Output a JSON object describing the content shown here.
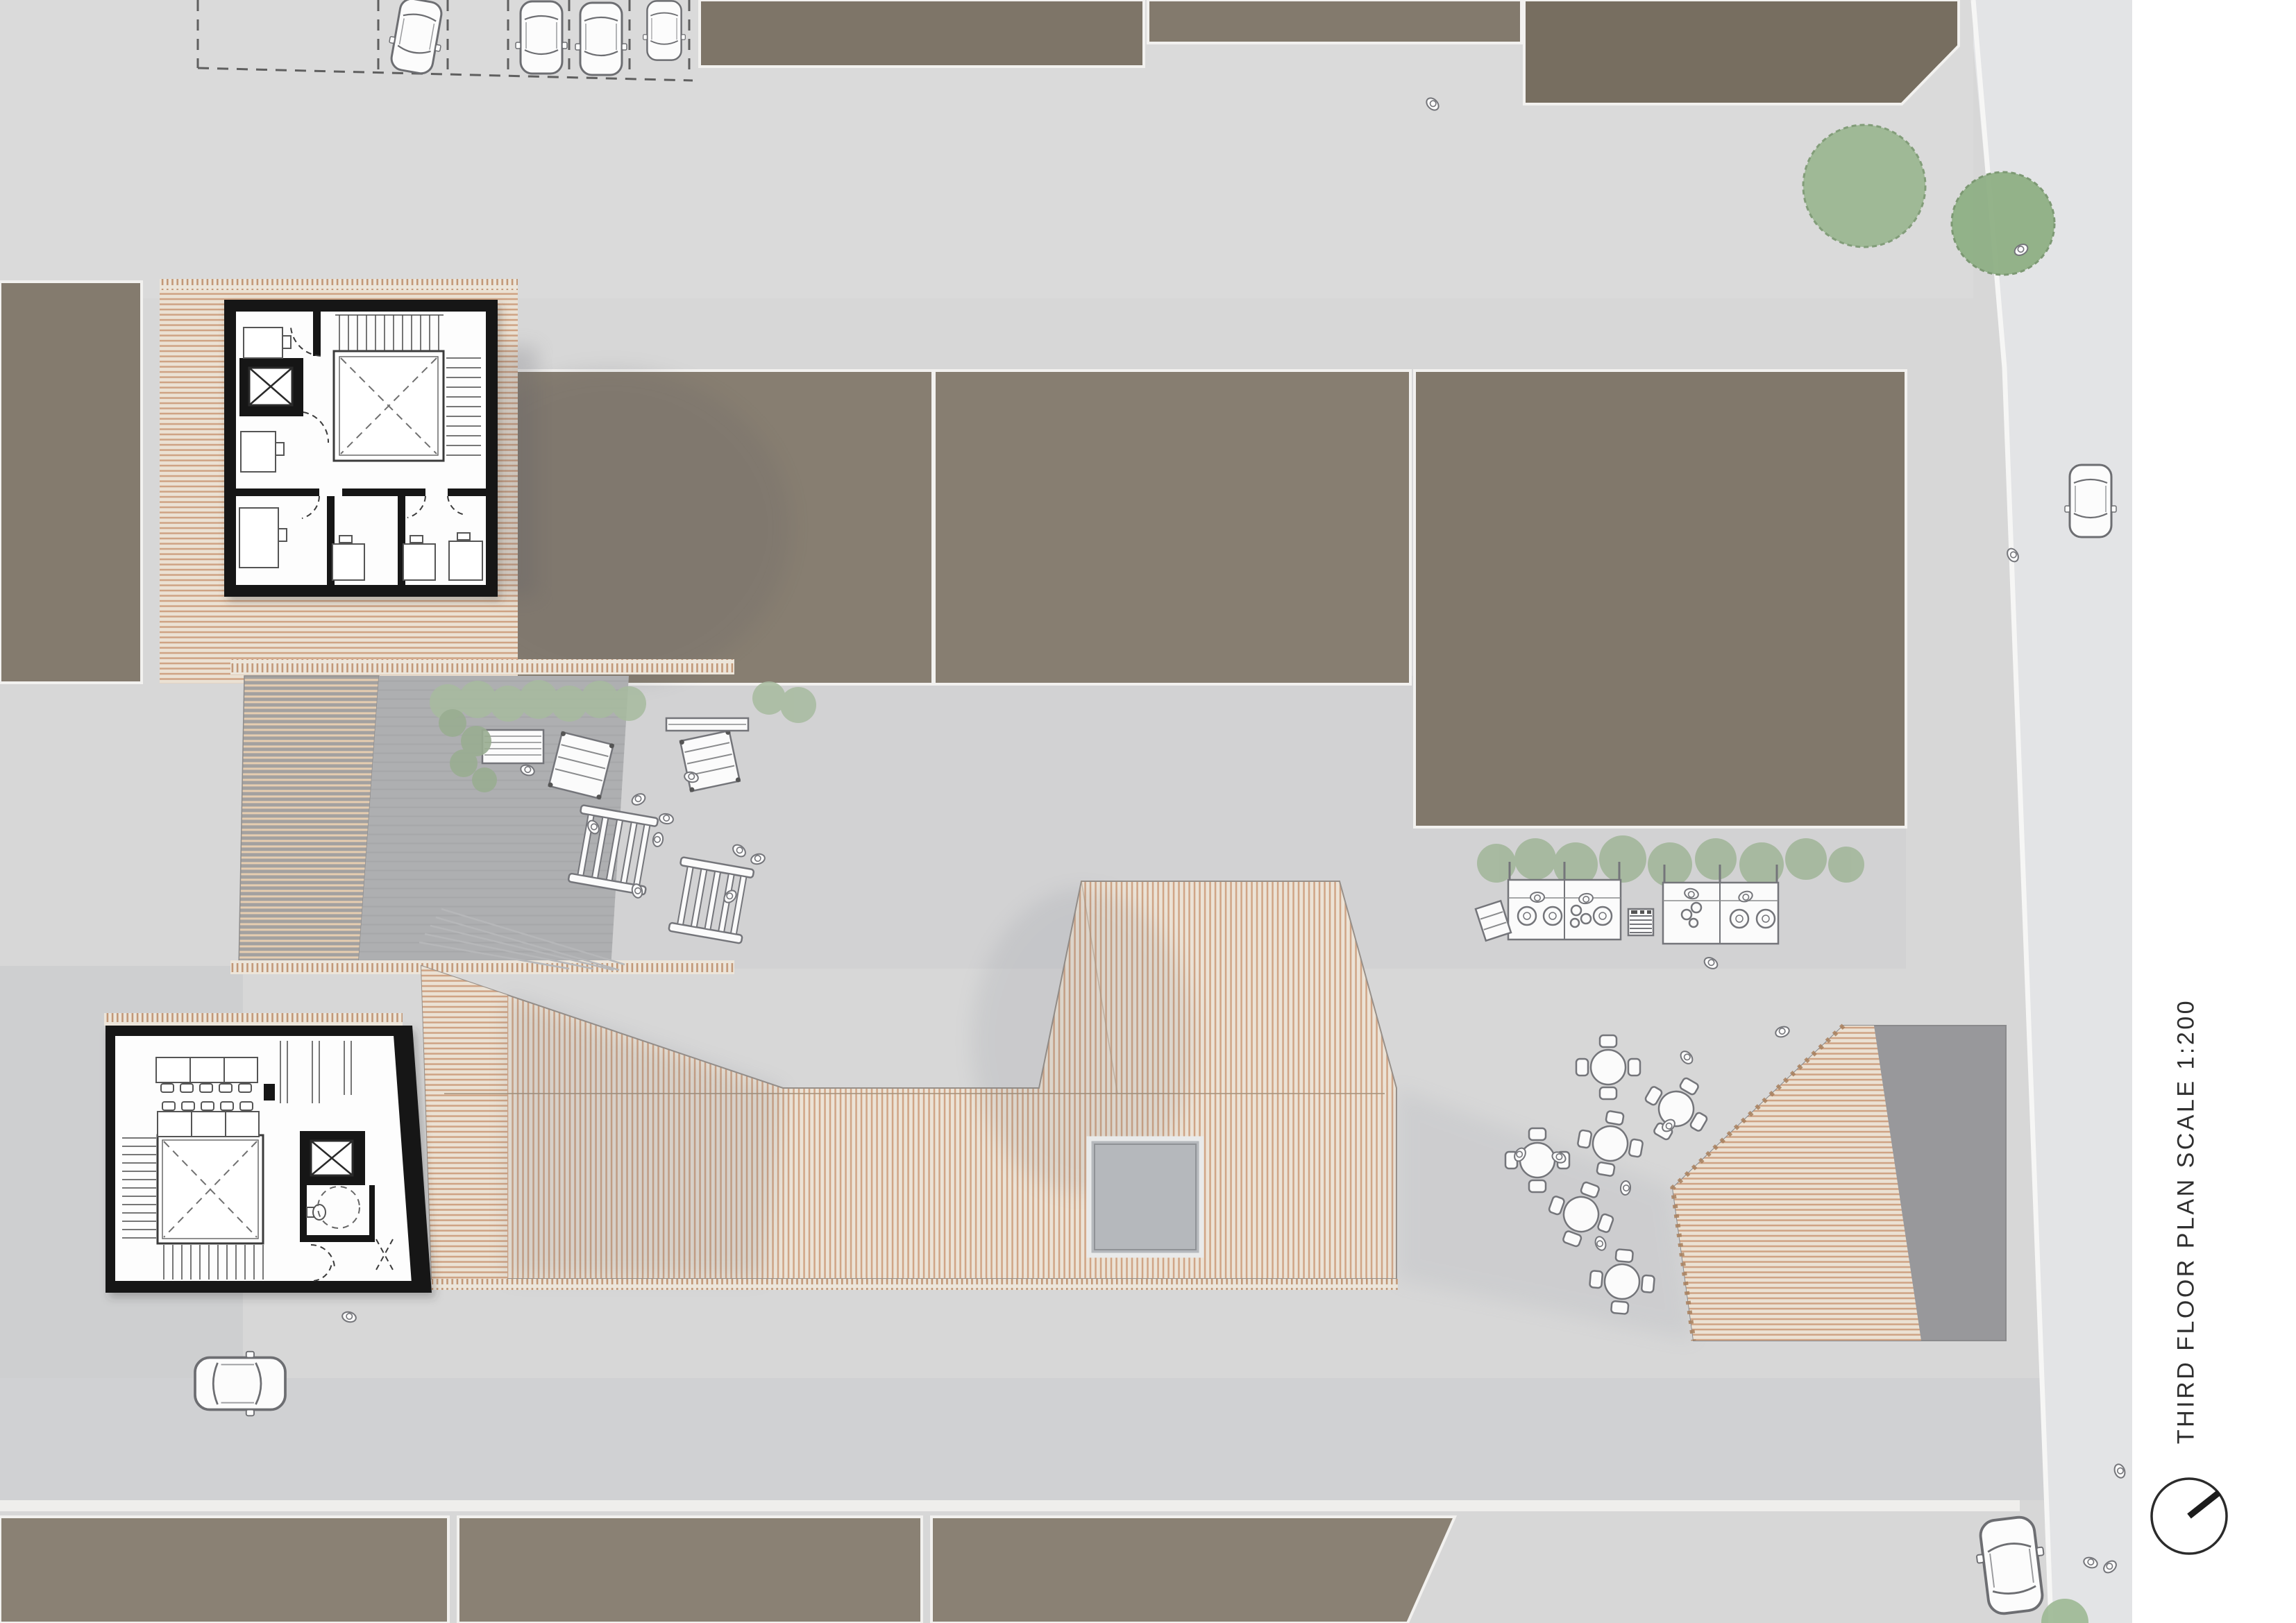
{
  "sheet": {
    "annotation": "THIRD FLOOR PLAN SCALE 1:200",
    "annotation_orientation": "vertical, reads bottom-to-top",
    "compass": "north-arrow-circle, needle pointing upper-right"
  },
  "palette": {
    "paper": "#ffffff",
    "plaza": "#d7d7d7",
    "plaza_dark": "#cdced0",
    "road": "#e3e4e6",
    "walkway_dark": "#aeafb1",
    "building_brown": "#857c6f",
    "building_brown_dark": "#776e60",
    "roof_hatch_bg": "#ece3d6",
    "roof_hatch_stripe": "#d0a586",
    "roof_gray": "#98989b",
    "plan_wall_black": "#161616",
    "tree_green": "#9cb893",
    "hedge_green": "#a3b79b",
    "drawing_line": "#74757a",
    "text": "#2f2f2f"
  }
}
